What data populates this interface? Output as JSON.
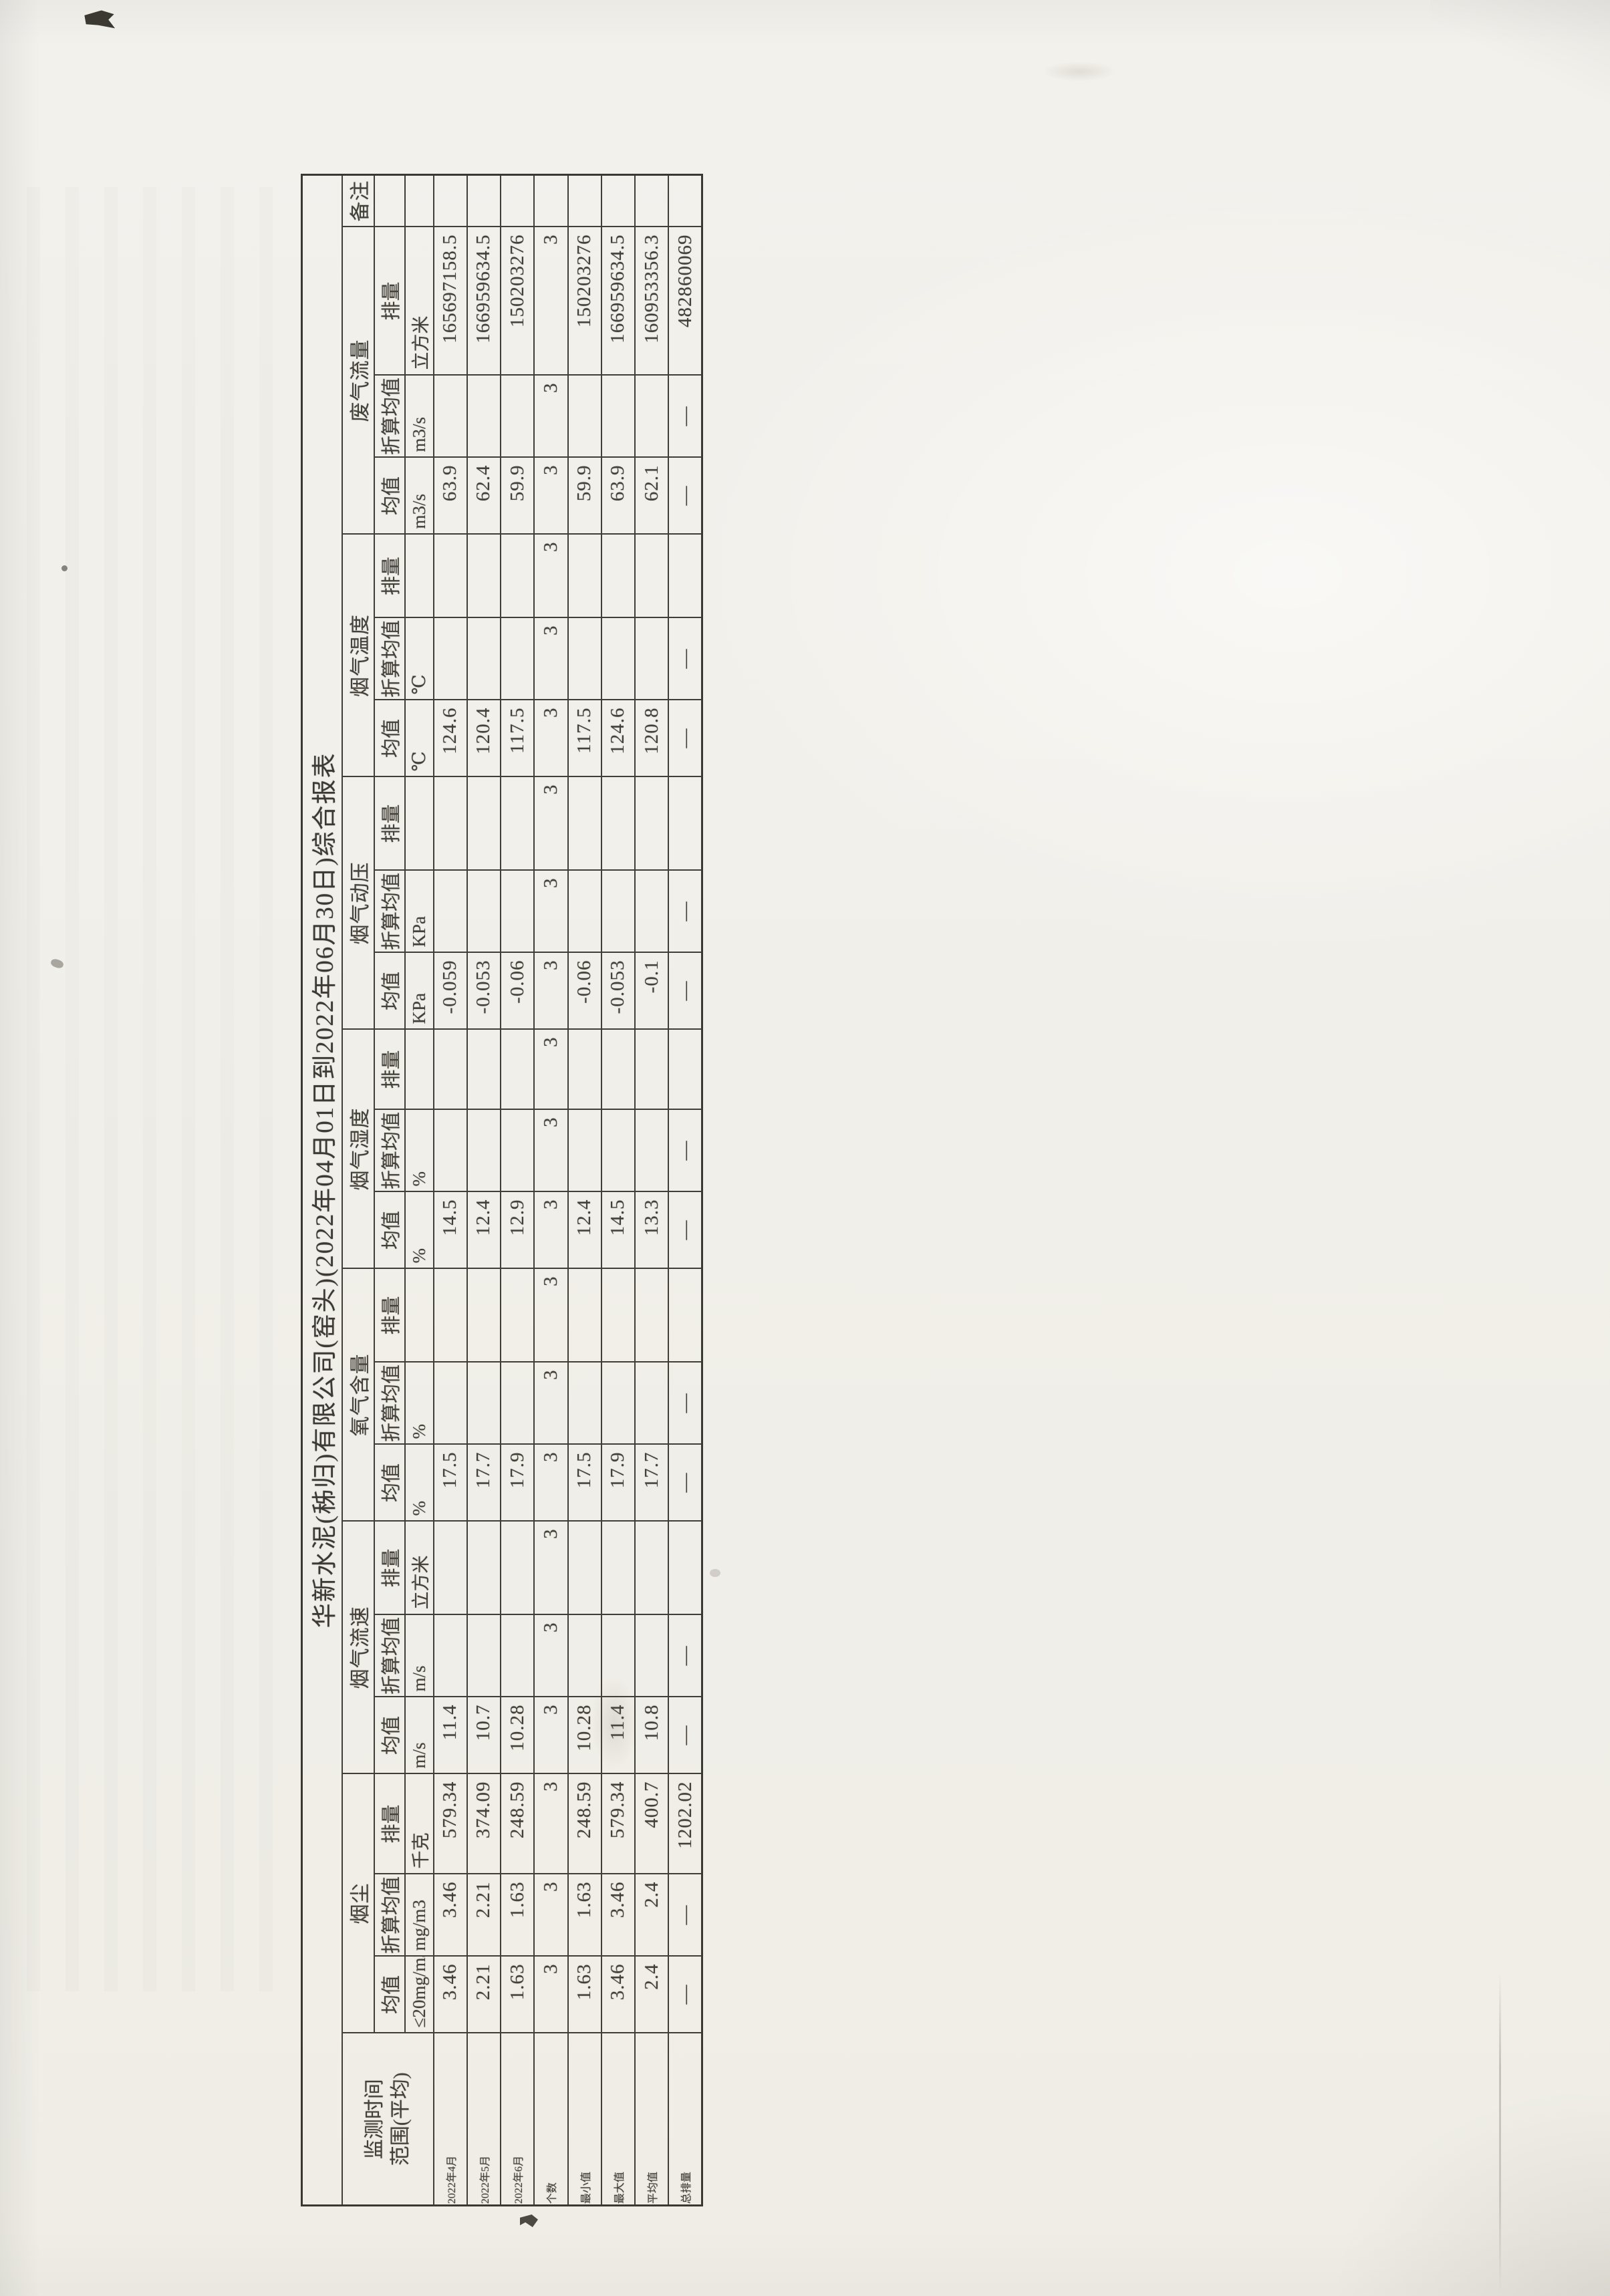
{
  "table": {
    "title": "华新水泥(秭归)有限公司(窑头)(2022年04月01日到2022年06月30日)综合报表",
    "row_header": {
      "line1": "监测时间",
      "line2": "范围(平均)"
    },
    "remark_header": "备注",
    "dash": "—",
    "row_labels": [
      "2022年4月",
      "2022年5月",
      "2022年6月",
      "个数",
      "最小值",
      "最大值",
      "平均值",
      "总排量"
    ],
    "groups": [
      {
        "key": "dust",
        "name": "烟尘",
        "columns": [
          {
            "sub": "均值",
            "unit": "≤20mg/m3",
            "values": [
              "3.46",
              "2.21",
              "1.63",
              "3",
              "1.63",
              "3.46",
              "2.4",
              "—"
            ]
          },
          {
            "sub": "折算均值",
            "unit": "mg/m3",
            "values": [
              "3.46",
              "2.21",
              "1.63",
              "3",
              "1.63",
              "3.46",
              "2.4",
              "—"
            ]
          },
          {
            "sub": "排量",
            "unit": "千克",
            "values": [
              "579.34",
              "374.09",
              "248.59",
              "3",
              "248.59",
              "579.34",
              "400.7",
              "1202.02"
            ]
          }
        ]
      },
      {
        "key": "flue-gas-velocity",
        "name": "烟气流速",
        "columns": [
          {
            "sub": "均值",
            "unit": "m/s",
            "values": [
              "11.4",
              "10.7",
              "10.28",
              "3",
              "10.28",
              "11.4",
              "10.8",
              "—"
            ]
          },
          {
            "sub": "折算均值",
            "unit": "m/s",
            "values": [
              "",
              "",
              "",
              "3",
              "",
              "",
              "",
              "—"
            ]
          },
          {
            "sub": "排量",
            "unit": "立方米",
            "values": [
              "",
              "",
              "",
              "3",
              "",
              "",
              "",
              ""
            ]
          }
        ]
      },
      {
        "key": "oxygen-content",
        "name": "氧气含量",
        "columns": [
          {
            "sub": "均值",
            "unit": "%",
            "values": [
              "17.5",
              "17.7",
              "17.9",
              "3",
              "17.5",
              "17.9",
              "17.7",
              "—"
            ]
          },
          {
            "sub": "折算均值",
            "unit": "%",
            "values": [
              "",
              "",
              "",
              "3",
              "",
              "",
              "",
              "—"
            ]
          },
          {
            "sub": "排量",
            "unit": "",
            "values": [
              "",
              "",
              "",
              "3",
              "",
              "",
              "",
              ""
            ]
          }
        ]
      },
      {
        "key": "flue-gas-humidity",
        "name": "烟气湿度",
        "columns": [
          {
            "sub": "均值",
            "unit": "%",
            "values": [
              "14.5",
              "12.4",
              "12.9",
              "3",
              "12.4",
              "14.5",
              "13.3",
              "—"
            ]
          },
          {
            "sub": "折算均值",
            "unit": "%",
            "values": [
              "",
              "",
              "",
              "3",
              "",
              "",
              "",
              "—"
            ]
          },
          {
            "sub": "排量",
            "unit": "",
            "values": [
              "",
              "",
              "",
              "3",
              "",
              "",
              "",
              ""
            ]
          }
        ]
      },
      {
        "key": "flue-gas-dynamic-pressure",
        "name": "烟气动压",
        "columns": [
          {
            "sub": "均值",
            "unit": "KPa",
            "values": [
              "-0.059",
              "-0.053",
              "-0.06",
              "3",
              "-0.06",
              "-0.053",
              "-0.1",
              "—"
            ]
          },
          {
            "sub": "折算均值",
            "unit": "KPa",
            "values": [
              "",
              "",
              "",
              "3",
              "",
              "",
              "",
              "—"
            ]
          },
          {
            "sub": "排量",
            "unit": "",
            "values": [
              "",
              "",
              "",
              "3",
              "",
              "",
              "",
              ""
            ]
          }
        ]
      },
      {
        "key": "flue-gas-temperature",
        "name": "烟气温度",
        "columns": [
          {
            "sub": "均值",
            "unit": "℃",
            "values": [
              "124.6",
              "120.4",
              "117.5",
              "3",
              "117.5",
              "124.6",
              "120.8",
              "—"
            ]
          },
          {
            "sub": "折算均值",
            "unit": "℃",
            "values": [
              "",
              "",
              "",
              "3",
              "",
              "",
              "",
              "—"
            ]
          },
          {
            "sub": "排量",
            "unit": "",
            "values": [
              "",
              "",
              "",
              "3",
              "",
              "",
              "",
              ""
            ]
          }
        ]
      },
      {
        "key": "waste-gas-flow",
        "name": "废气流量",
        "columns": [
          {
            "sub": "均值",
            "unit": "m3/s",
            "values": [
              "63.9",
              "62.4",
              "59.9",
              "3",
              "59.9",
              "63.9",
              "62.1",
              "—"
            ]
          },
          {
            "sub": "折算均值",
            "unit": "m3/s",
            "values": [
              "",
              "",
              "",
              "3",
              "",
              "",
              "",
              "—"
            ]
          },
          {
            "sub": "排量",
            "unit": "立方米",
            "values": [
              "165697158.5",
              "166959634.5",
              "150203276",
              "3",
              "150203276",
              "166959634.5",
              "160953356.3",
              "482860069"
            ]
          }
        ]
      }
    ],
    "remark_values": [
      "",
      "",
      "",
      "",
      "",
      "",
      "",
      ""
    ]
  }
}
